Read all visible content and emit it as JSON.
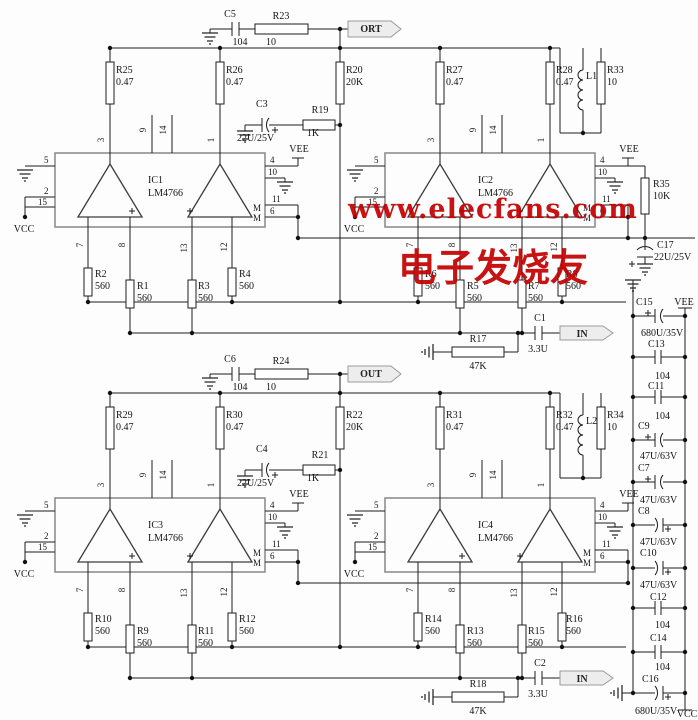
{
  "watermark": {
    "line1": "www.elecfans.com",
    "line2": "电子发烧友",
    "color": "#c30000"
  },
  "flags": {
    "ort": "ORT",
    "out": "OUT",
    "in": "IN"
  },
  "power": {
    "vcc": "VCC",
    "vee": "VEE"
  },
  "ics": [
    {
      "ref": "IC1",
      "part": "LM4766"
    },
    {
      "ref": "IC2",
      "part": "LM4766"
    },
    {
      "ref": "IC3",
      "part": "LM4766"
    },
    {
      "ref": "IC4",
      "part": "LM4766"
    }
  ],
  "pins": {
    "p1": "1",
    "p2": "2",
    "p3": "3",
    "p4": "4",
    "p5": "5",
    "p6": "6",
    "p7": "7",
    "p8": "8",
    "p9": "9",
    "p10": "10",
    "p11": "11",
    "p12": "12",
    "p13": "13",
    "p14": "14",
    "p15": "15",
    "m": "M"
  },
  "resistors": {
    "R1": {
      "r": "R1",
      "v": "560"
    },
    "R2": {
      "r": "R2",
      "v": "560"
    },
    "R3": {
      "r": "R3",
      "v": "560"
    },
    "R4": {
      "r": "R4",
      "v": "560"
    },
    "R5": {
      "r": "R5",
      "v": "560"
    },
    "R6": {
      "r": "R6",
      "v": "560"
    },
    "R7": {
      "r": "R7",
      "v": "560"
    },
    "R8": {
      "r": "R8",
      "v": "560"
    },
    "R9": {
      "r": "R9",
      "v": "560"
    },
    "R10": {
      "r": "R10",
      "v": "560"
    },
    "R11": {
      "r": "R11",
      "v": "560"
    },
    "R12": {
      "r": "R12",
      "v": "560"
    },
    "R13": {
      "r": "R13",
      "v": "560"
    },
    "R14": {
      "r": "R14",
      "v": "560"
    },
    "R15": {
      "r": "R15",
      "v": "560"
    },
    "R16": {
      "r": "R16",
      "v": "560"
    },
    "R17": {
      "r": "R17",
      "v": "47K"
    },
    "R18": {
      "r": "R18",
      "v": "47K"
    },
    "R19": {
      "r": "R19",
      "v": "1K"
    },
    "R20": {
      "r": "R20",
      "v": "20K"
    },
    "R21": {
      "r": "R21",
      "v": "1K"
    },
    "R22": {
      "r": "R22",
      "v": "20K"
    },
    "R23": {
      "r": "R23",
      "v": "10"
    },
    "R24": {
      "r": "R24",
      "v": "10"
    },
    "R25": {
      "r": "R25",
      "v": "0.47"
    },
    "R26": {
      "r": "R26",
      "v": "0.47"
    },
    "R27": {
      "r": "R27",
      "v": "0.47"
    },
    "R28": {
      "r": "R28",
      "v": "0.47"
    },
    "R29": {
      "r": "R29",
      "v": "0.47"
    },
    "R30": {
      "r": "R30",
      "v": "0.47"
    },
    "R31": {
      "r": "R31",
      "v": "0.47"
    },
    "R32": {
      "r": "R32",
      "v": "0.47"
    },
    "R33": {
      "r": "R33",
      "v": "10"
    },
    "R34": {
      "r": "R34",
      "v": "10"
    },
    "R35": {
      "r": "R35",
      "v": "10K"
    }
  },
  "capacitors": {
    "C1": {
      "r": "C1",
      "v": "3.3U"
    },
    "C2": {
      "r": "C2",
      "v": "3.3U"
    },
    "C3": {
      "r": "C3",
      "v": "22U/25V"
    },
    "C4": {
      "r": "C4",
      "v": "22U/25V"
    },
    "C5": {
      "r": "C5",
      "v": "104"
    },
    "C6": {
      "r": "C6",
      "v": "104"
    },
    "C7": {
      "r": "C7",
      "v": "47U/63V"
    },
    "C8": {
      "r": "C8",
      "v": "47U/63V"
    },
    "C9": {
      "r": "C9",
      "v": "47U/63V"
    },
    "C10": {
      "r": "C10",
      "v": "47U/63V"
    },
    "C11": {
      "r": "C11",
      "v": "104"
    },
    "C12": {
      "r": "C12",
      "v": "104"
    },
    "C13": {
      "r": "C13",
      "v": "104"
    },
    "C14": {
      "r": "C14",
      "v": "104"
    },
    "C15": {
      "r": "C15",
      "v": "680U/35V"
    },
    "C16": {
      "r": "C16",
      "v": "680U/35V"
    },
    "C17": {
      "r": "C17",
      "v": "22U/25V"
    }
  },
  "inductors": {
    "L1": {
      "r": "L1"
    },
    "L2": {
      "r": "L2"
    }
  }
}
